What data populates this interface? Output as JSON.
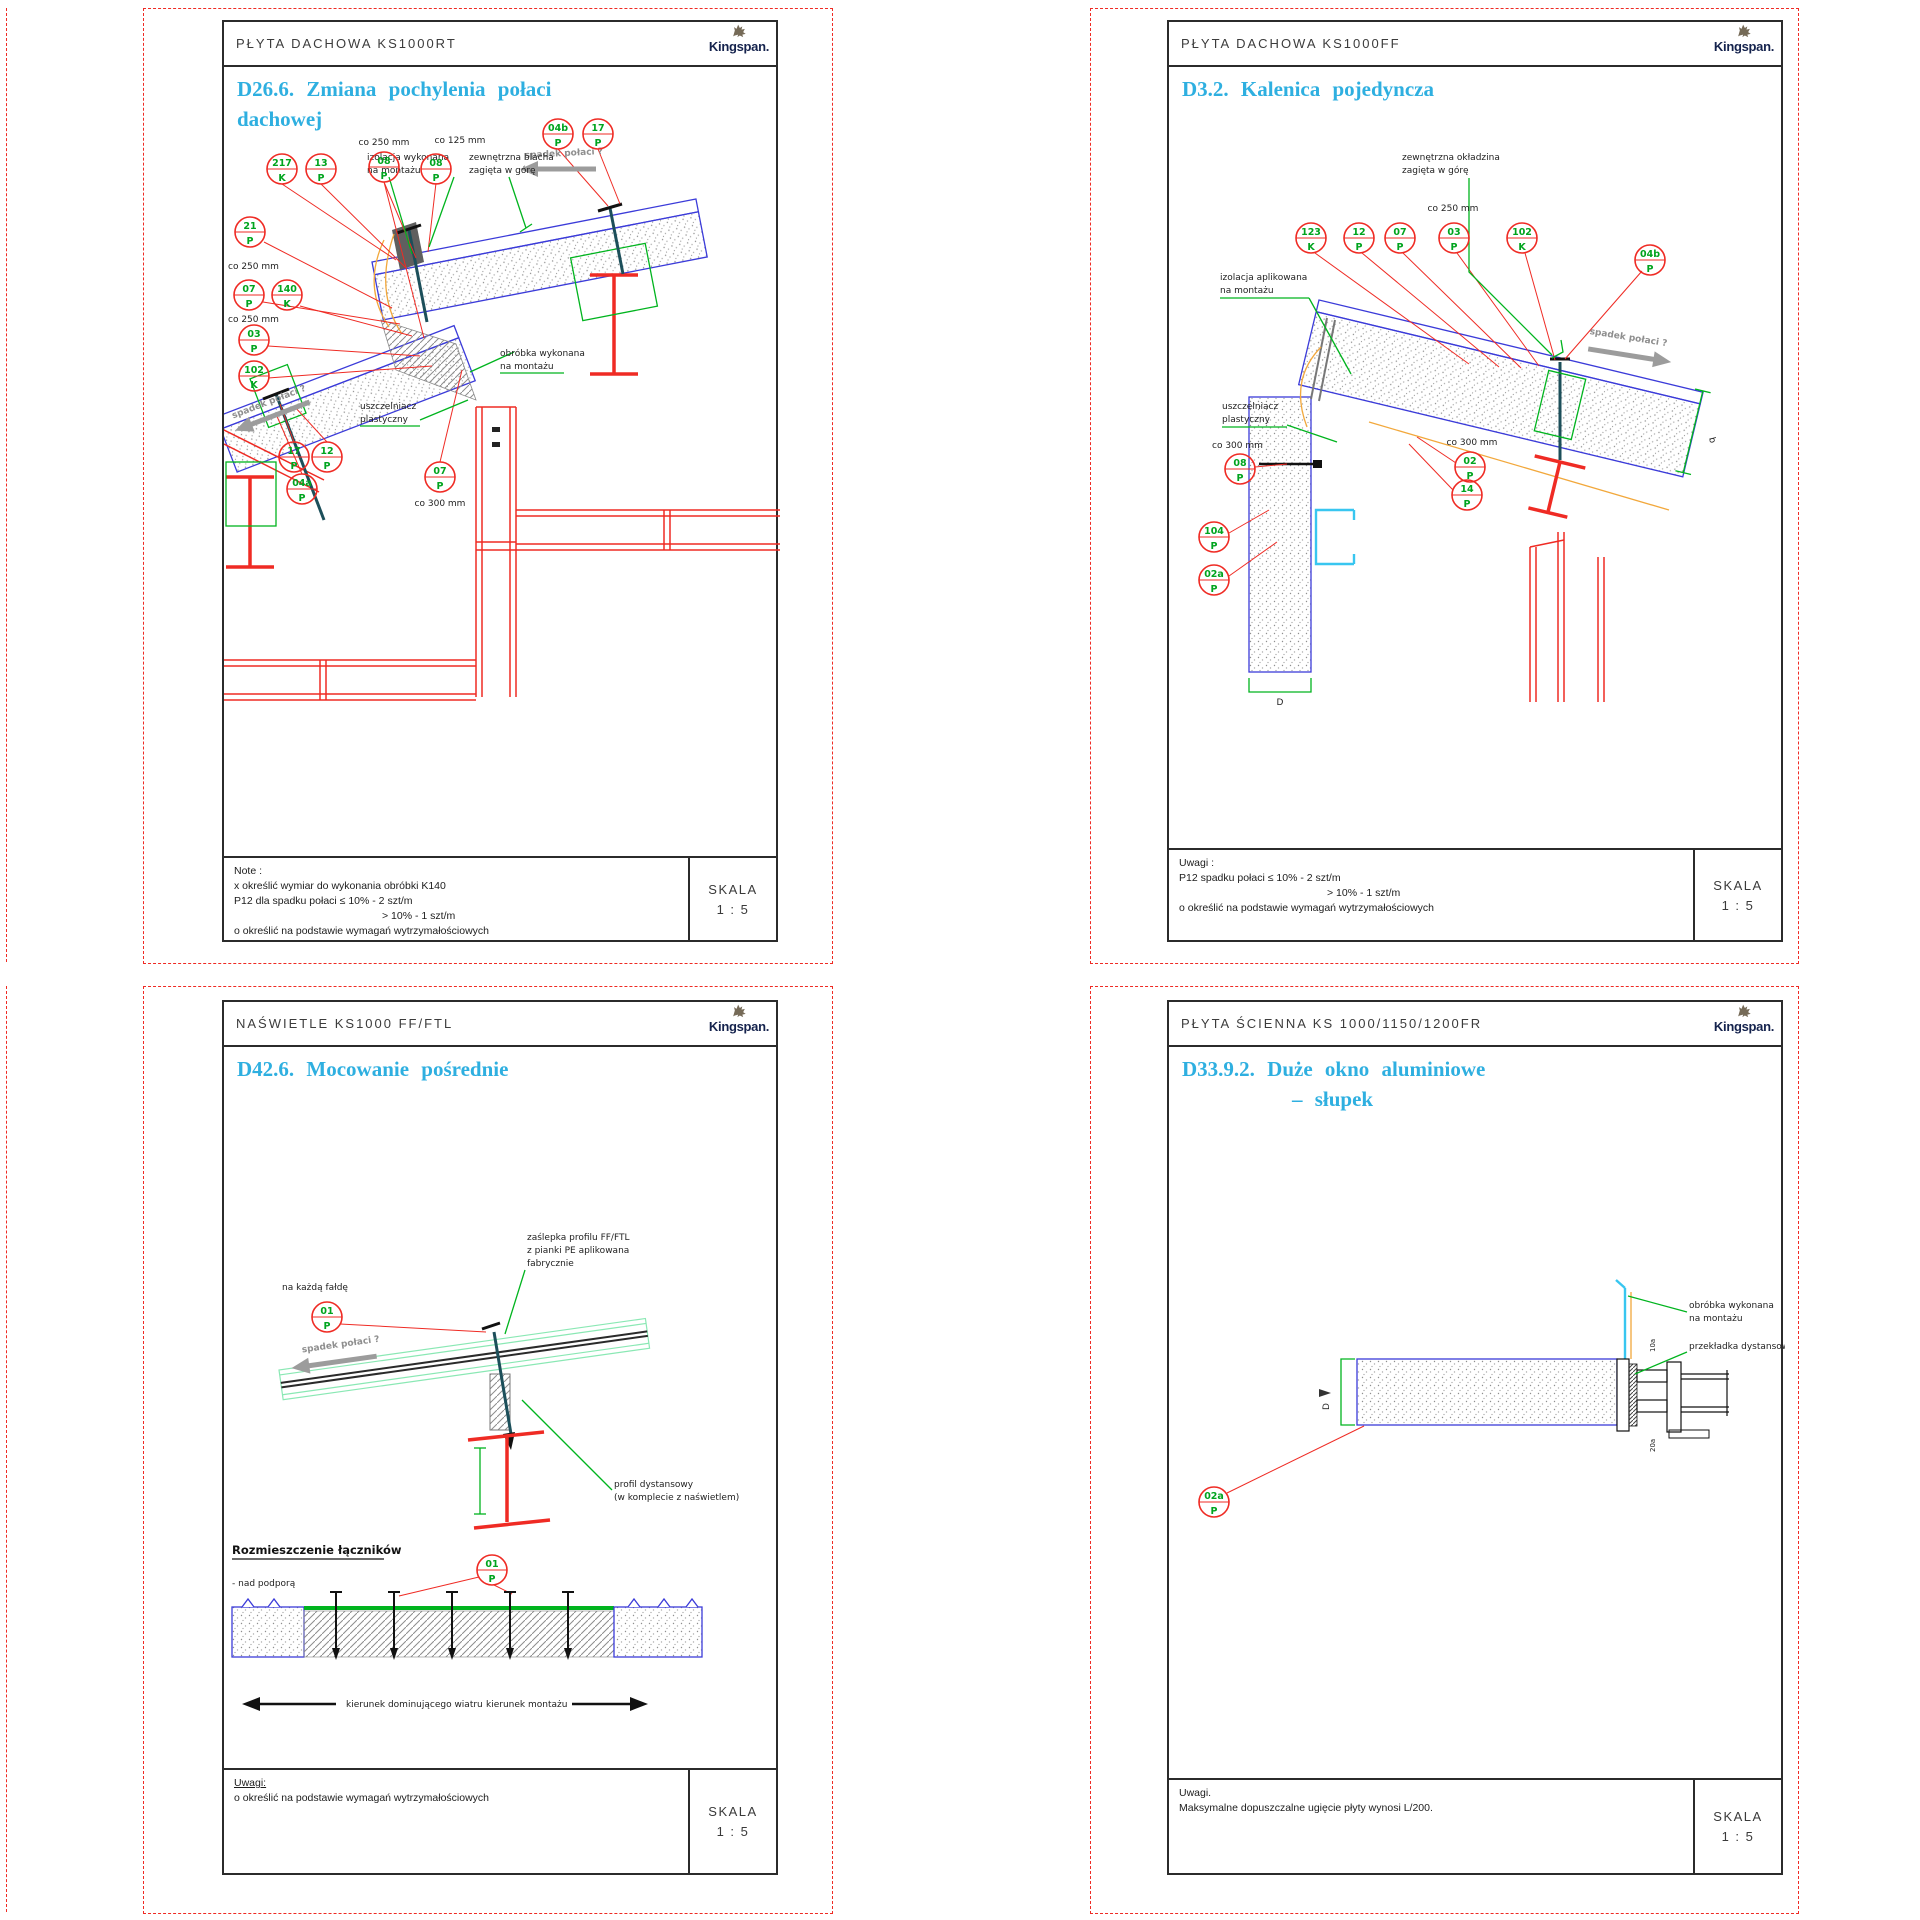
{
  "brand": {
    "name": "Kingspan."
  },
  "scale": {
    "label": "SKALA",
    "value": "1 : 5"
  },
  "sheets": {
    "tl": {
      "header": "PŁYTA DACHOWA KS1000RT",
      "title1": "D26.6. Zmiana pochylenia połaci",
      "title2": "dachowej",
      "notes": [
        "Note :",
        "x  określić wymiar do wykonania obróbki K140",
        "P12 dla spadku połaci ≤ 10% - 2 szt/m",
        "> 10% - 1 szt/m",
        "o  określić na podstawie wymagań wytrzymałościowych"
      ],
      "labels": {
        "co250_top": "co 250 mm",
        "co125": "co 125 mm",
        "co250_left1": "co 250 mm",
        "co250_left2": "co 250 mm",
        "co300": "co 300 mm",
        "spadek": "spadek połaci ?",
        "izolacja1": "izolacja wykonana",
        "izolacja2": "na montażu",
        "blacha1": "zewnętrzna blacha",
        "blacha2": "zagięta w górę",
        "obrobka1": "obróbka wykonana",
        "obrobka2": "na montażu",
        "uszczelniacz1": "uszczelniacz",
        "uszczelniacz2": "plastyczny"
      },
      "callouts": [
        {
          "code": "217",
          "letter": "K"
        },
        {
          "code": "13",
          "letter": "P"
        },
        {
          "code": "08",
          "letter": "P"
        },
        {
          "code": "08",
          "letter": "P"
        },
        {
          "code": "04b",
          "letter": "P"
        },
        {
          "code": "17",
          "letter": "P"
        },
        {
          "code": "21",
          "letter": "P"
        },
        {
          "code": "07",
          "letter": "P"
        },
        {
          "code": "140",
          "letter": "K"
        },
        {
          "code": "03",
          "letter": "P"
        },
        {
          "code": "102",
          "letter": "K"
        },
        {
          "code": "17",
          "letter": "P"
        },
        {
          "code": "12",
          "letter": "P"
        },
        {
          "code": "04a",
          "letter": "P"
        },
        {
          "code": "07",
          "letter": "P"
        }
      ]
    },
    "tr": {
      "header": "PŁYTA DACHOWA KS1000FF",
      "title1": "D3.2. Kalenica pojedyncza",
      "notes": [
        "Uwagi :",
        "P12 spadku połaci ≤ 10% - 2 szt/m",
        "> 10% - 1 szt/m",
        "o  określić na podstawie wymagań wytrzymałościowych"
      ],
      "labels": {
        "zewnetrzna1": "zewnętrzna okładzina",
        "zewnetrzna2": "zagięta w górę",
        "co250": "co 250 mm",
        "izolacja1": "izolacja aplikowana",
        "izolacja2": "na montażu",
        "uszczelniacz1": "uszczelniacz",
        "uszczelniacz2": "plastyczny",
        "co300_left": "co 300 mm",
        "co300_right": "co 300 mm",
        "spadek": "spadek połaci ?",
        "dim_b": "b",
        "dim_d": "D"
      },
      "callouts": [
        {
          "code": "123",
          "letter": "K"
        },
        {
          "code": "12",
          "letter": "P"
        },
        {
          "code": "07",
          "letter": "P"
        },
        {
          "code": "03",
          "letter": "P"
        },
        {
          "code": "102",
          "letter": "K"
        },
        {
          "code": "04b",
          "letter": "P"
        },
        {
          "code": "08",
          "letter": "P"
        },
        {
          "code": "104",
          "letter": "P"
        },
        {
          "code": "02a",
          "letter": "P"
        },
        {
          "code": "02",
          "letter": "P"
        },
        {
          "code": "14",
          "letter": "P"
        }
      ]
    },
    "bl": {
      "header": "NAŚWIETLE KS1000 FF/FTL",
      "title1": "D42.6. Mocowanie pośrednie",
      "notes": [
        "Uwagi:",
        "o  określić na podstawie wymagań wytrzymałościowych"
      ],
      "labels": {
        "kazda": "na każdą fałdę",
        "zaslepka1": "zaślepka profilu FF/FTL",
        "zaslepka2": "z pianki PE aplikowana",
        "zaslepka3": "fabrycznie",
        "spadek": "spadek połaci ?",
        "profil1": "profil dystansowy",
        "profil2": "(w komplecie z naświetlem)",
        "heading": "Rozmieszczenie łączników",
        "nad": "- nad podporą",
        "wiatr": "kierunek dominującego wiatru",
        "montaz": "kierunek montażu"
      },
      "callouts": [
        {
          "code": "01",
          "letter": "P"
        },
        {
          "code": "01",
          "letter": "P"
        }
      ]
    },
    "br": {
      "header": "PŁYTA ŚCIENNA KS 1000/1150/1200FR",
      "title1": "D33.9.2. Duże okno aluminiowe",
      "title2": "– słupek",
      "notes": [
        "Uwagi.",
        "Maksymalne dopuszczalne ugięcie płyty wynosi L/200."
      ],
      "labels": {
        "obrobka1": "obróbka wykonana",
        "obrobka2": "na montażu",
        "przekladka": "przekładka dystansowa",
        "dim_d": "D",
        "dim_10a": "10a",
        "dim_20a": "20a"
      },
      "callouts": [
        {
          "code": "02a",
          "letter": "P"
        }
      ]
    }
  }
}
